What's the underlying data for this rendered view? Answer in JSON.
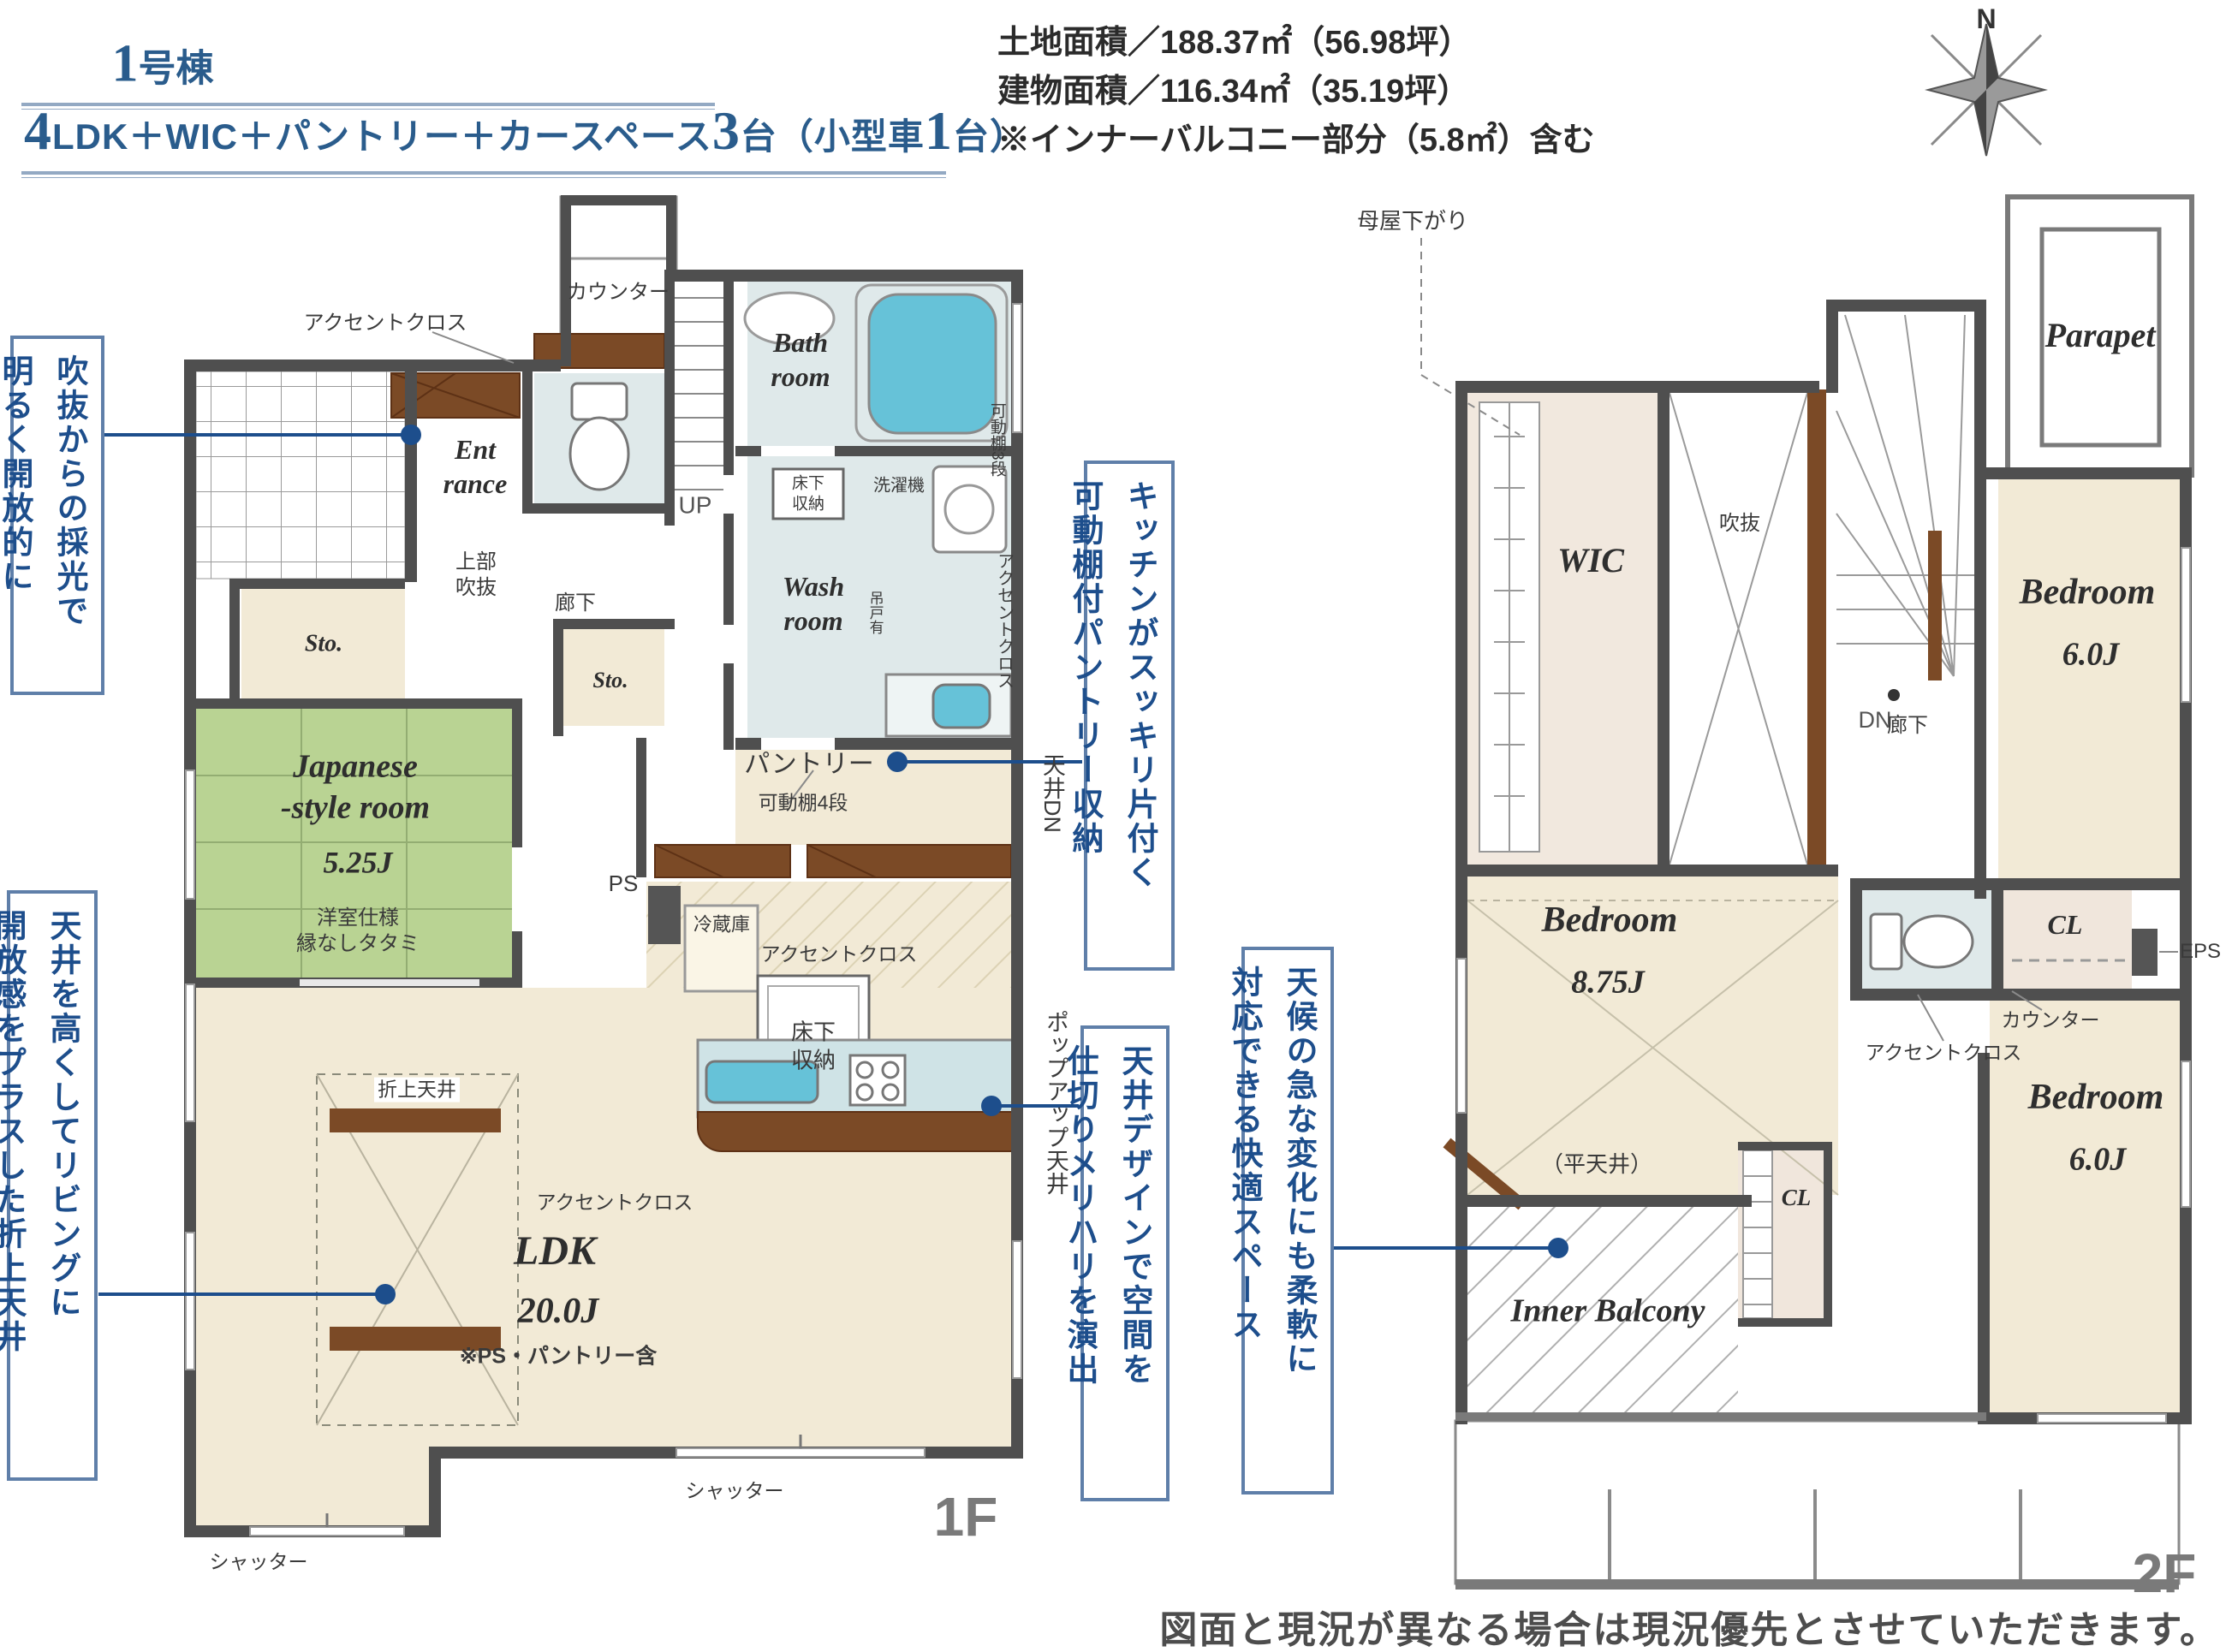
{
  "colors": {
    "accent_blue": "#1d4e8c",
    "wall": "#4f4f4f",
    "cream": "#f2ead6",
    "tatami": "#b9d393",
    "water": "#66c2d8",
    "wet_room": "#dfe9ea",
    "brown": "#7b4a26",
    "title_blue": "#2a5c8c"
  },
  "header": {
    "no": "1",
    "no_suffix": "号棟",
    "spec": {
      "s0": "4",
      "s1": "LDK＋WIC＋パントリー＋カースペース",
      "s2": "3",
      "s3": "台（小型車",
      "s4": "1",
      "s5": "台）"
    },
    "info": {
      "l1": "土地面積／188.37㎡（56.98坪）",
      "l2": "建物面積／116.34㎡（35.19坪）",
      "l3": "※インナーバルコニー部分（5.8㎡）含む"
    },
    "compass_n": "N"
  },
  "annotations": {
    "a1": {
      "l1": "吹抜からの採光で",
      "l2": "明るく開放的に"
    },
    "a2": {
      "l1": "天井を高くしてリビングに",
      "l2": "開放感をプラスした折上天井"
    },
    "a3": {
      "l1": "キッチンがスッキリ片付く",
      "l2": "可動棚付パントリー収納"
    },
    "a4": {
      "l1": "天井デザインで空間を",
      "l2": "仕切りメリハリを演出"
    },
    "a5": {
      "l1": "天候の急な変化にも柔軟に",
      "l2": "対応できる快適スペース"
    }
  },
  "f1": {
    "floor": "1F",
    "ent": "Ent\nrance",
    "bath": "Bath\nroom",
    "wash": "Wash\nroom",
    "sto1": "Sto.",
    "sto2": "Sto.",
    "jp1": "Japanese\n-style room",
    "jp2": "5.25J",
    "jp3": "洋室仕様\n縁なしタタミ",
    "ldk1": "LDK",
    "ldk2": "20.0J",
    "ldk3": "※PS・パントリー含",
    "pantry1": "パントリー",
    "pantry2": "可動棚4段",
    "up": "UP",
    "rouka": "廊下",
    "joubu": "上部\n吹抜",
    "counter": "カウンター",
    "accent_top": "アクセントクロス",
    "accent_mid": "アクセントクロス",
    "accent_btm": "アクセントクロス",
    "fridge": "冷蔵庫",
    "yuka1": "床下\n収納",
    "yuka2": "床下\n収納",
    "sentaku": "洗濯機",
    "tsurido": "吊戸有",
    "ps": "PS",
    "oriage": "折上天井",
    "shutter1": "シャッター",
    "shutter2": "シャッター",
    "v_tenjo": "天井DN",
    "v_popup": "ポップアップ天井",
    "v_kadou": "可動棚3段",
    "v_accent": "アクセントクロス"
  },
  "f2": {
    "floor": "2F",
    "moya": "母屋下がり",
    "wic": "WIC",
    "fukinuke": "吹抜",
    "dn": "DN",
    "parapet": "Parapet",
    "bed1a": "Bedroom",
    "bed1b": "6.0J",
    "bed2a": "Bedroom",
    "bed2b": "8.75J",
    "bed2c": "（平天井）",
    "bed3a": "Bedroom",
    "bed3b": "6.0J",
    "rouka": "廊下",
    "cl1": "CL",
    "cl2": "CL",
    "eps": "EPS",
    "counter": "カウンター",
    "accent": "アクセントクロス",
    "balcony": "Inner Balcony"
  },
  "footer": {
    "note": "図面と現況が異なる場合は現況優先とさせていただきます。"
  }
}
